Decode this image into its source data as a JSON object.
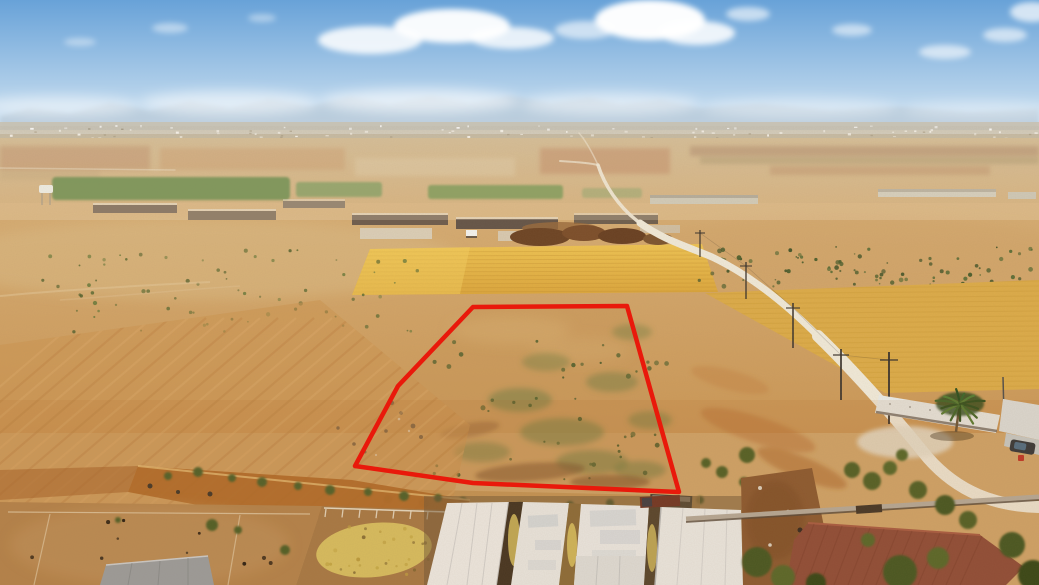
{
  "scene": {
    "type": "aerial-drone-photograph",
    "subject": "rural-land-plot-outlined-in-red",
    "features": [
      "sky",
      "clouds",
      "horizon-haze",
      "distant-mountains",
      "distant-town",
      "farmland-patchwork",
      "green-crop-fields",
      "farm-buildings",
      "water-tower",
      "golden-wheat-field-center",
      "golden-wheat-field-right",
      "excavated-dirt-mound",
      "white-dirt-road",
      "power-poles",
      "scrubland-band",
      "red-plot-boundary",
      "plowed-furrow-field",
      "embankment",
      "livestock-yard",
      "grain-pile",
      "warehouse-roofs",
      "metal-roof-building",
      "stone-wall",
      "palm-tree",
      "parked-car",
      "trees-and-bushes",
      "shed-roof",
      "trailer"
    ],
    "colors": {
      "sky_top": "#68a2d8",
      "sky_horizon": "#dceaf4",
      "cloud": "#ffffff",
      "haze": "#e6eef4",
      "mountain": "#aebfce",
      "town_strip": "#c8c0ae",
      "far_field_light": "#cdb389",
      "far_field_warm": "#d0a76e",
      "mid_field_top": "#d6ad74",
      "mid_field_bottom": "#cb9756",
      "wheat_bright": "#eec352",
      "wheat_deep": "#dca63c",
      "wheat_right": "#dcab49",
      "plowed_orange": "#cb9350",
      "furrow_dark": "#b87c3e",
      "furrow_light": "#e0b071",
      "embankment_orange": "#b06a28",
      "dirt_yard": "#b5854e",
      "dirt_brown": "#8a5a32",
      "road_white": "#f0e9d8",
      "scrub_green": "#55622f",
      "bush_green": "#4c6029",
      "crop_green": "#4f7c33",
      "weed_green": "#6e7c3f",
      "palm_green": "#2f501f",
      "palm_light": "#4d7329",
      "roof_white": "#f2f3f1",
      "roof_mottle_blue": "#ccd6dd",
      "roof_maroon": "#8e4b39",
      "roof_shed_gray": "#9aa1a5",
      "grain_yellow": "#dbc565",
      "wall_gray": "#b6ad9f",
      "pole_dark": "#3a332c",
      "boundary_red": "#e9190b"
    },
    "plot_boundary": {
      "shape": "polygon",
      "points": "473,307 627,306 679,492 473,483 355,466 398,386",
      "stroke_px": 4.5,
      "color": "#e9190b"
    }
  }
}
